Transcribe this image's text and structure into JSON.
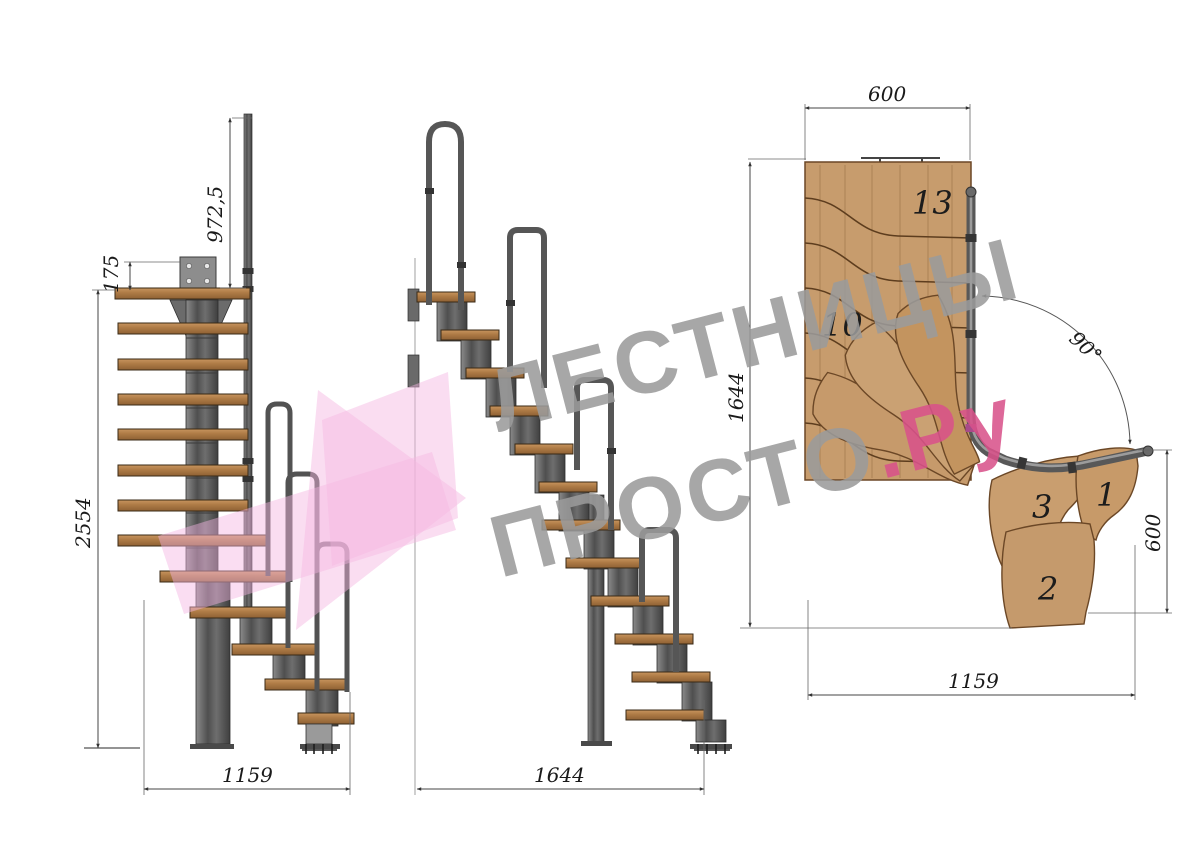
{
  "title": "Чертеж модульной лестницы с поворотом 90°",
  "views": {
    "side_view": {
      "label": "боковая проекция",
      "dimensions": {
        "handrail_post_height": "972,5",
        "top_landing_offset": "175",
        "total_height": "2554",
        "plan_width": "1159"
      }
    },
    "front_view": {
      "label": "фронтальная проекция",
      "dimensions": {
        "total_length": "1644"
      }
    },
    "plan_view": {
      "label": "вид сверху",
      "dimensions": {
        "upper_flight_width": "600",
        "total_depth": "1644",
        "turn_angle": "90°",
        "corner_depth": "600",
        "total_width": "1159"
      },
      "tread_labels": {
        "t13": "13",
        "t10": "10",
        "t3": "3",
        "t1": "1",
        "t2": "2"
      }
    }
  },
  "watermark": {
    "line1": "ЛЕСТНИЦЫ",
    "line2_main": "ПРОСТО",
    "line2_suffix": ".Ру"
  },
  "colors": {
    "wood_side": "#b5义8352",
    "wood_plan": "#c79c6d",
    "metal": "#5f5f5f",
    "dimension_line": "#4a4a4a",
    "watermark_gray": "#9b9b9b",
    "watermark_pink": "#d9528a",
    "arrow_pink": "#f5b5e2"
  }
}
